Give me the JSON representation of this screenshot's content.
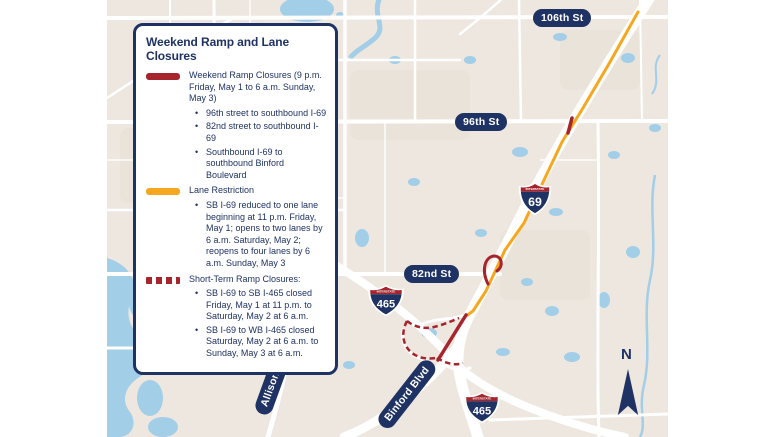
{
  "theme": {
    "colors": {
      "navy": "#1E3263",
      "red": "#A6242B",
      "orange": "#F5A81F",
      "water": "#A2CEE8",
      "mapbg": "#EDE7E0",
      "road": "#FFFFFF",
      "patch": "#E7E0D6"
    }
  },
  "legend": {
    "title": "Weekend Ramp and Lane Closures",
    "items": [
      {
        "swatch": "solid-red",
        "label": "Weekend Ramp Closures (9 p.m. Friday, May 1 to 6 a.m. Sunday, May 3)",
        "bullets": [
          "96th street to southbound I-69",
          "82nd street to southbound I-69",
          "Southbound I-69 to southbound Binford Boulevard"
        ]
      },
      {
        "swatch": "solid-orange",
        "label": "Lane Restriction",
        "bullets": [
          "SB I-69 reduced to one lane beginning at 11 p.m. Friday, May 1; opens to two lanes by 6 a.m. Saturday, May 2; reopens to four lanes by 6 a.m. Sunday, May 3"
        ]
      },
      {
        "swatch": "dashed-red",
        "label": "Short-Term Ramp Closures:",
        "bullets": [
          "SB I-69 to SB I-465 closed Friday, May 1 at 11 p.m. to Saturday, May 2 at 6 a.m.",
          "SB I-69 to WB I-465 closed Saturday, May 2 at 6 a.m. to Sunday, May 3 at 6 a.m."
        ]
      }
    ]
  },
  "map": {
    "streets": [
      {
        "label": "106th St"
      },
      {
        "label": "96th St"
      },
      {
        "label": "82nd St"
      }
    ],
    "roads": [
      {
        "label": "Allisonville Rd"
      },
      {
        "label": "Binford Blvd"
      }
    ],
    "shields": [
      {
        "header": "INTERSTATE",
        "number": "69"
      },
      {
        "header": "INTERSTATE",
        "number": "465"
      },
      {
        "header": "INTERSTATE",
        "number": "465"
      }
    ],
    "compass": {
      "label": "N"
    }
  }
}
